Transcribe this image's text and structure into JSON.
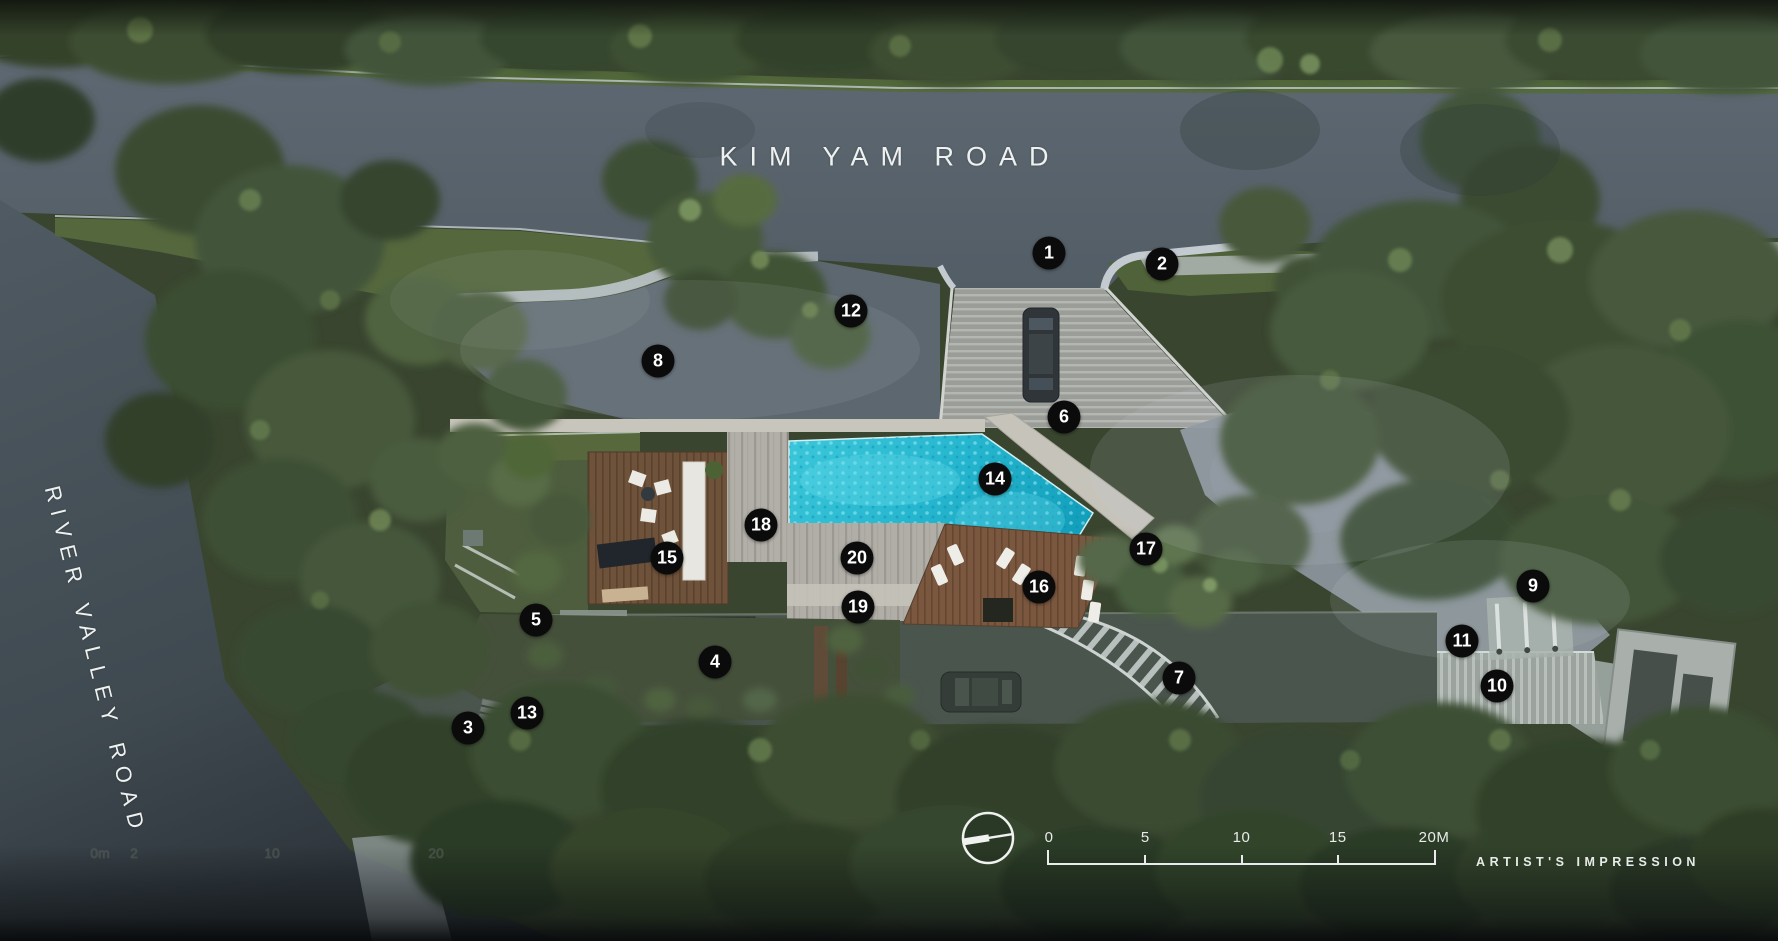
{
  "roads": {
    "top": "KIM YAM ROAD",
    "left": "RIVER VALLEY ROAD"
  },
  "credit": "ARTIST'S IMPRESSION",
  "scale_bar": {
    "labels": [
      "0",
      "5",
      "10",
      "15",
      "20M"
    ]
  },
  "ghost_scale": {
    "labels": [
      "0m",
      "2",
      "10",
      "20"
    ]
  },
  "markers": [
    {
      "n": "1",
      "x": 1049,
      "y": 253
    },
    {
      "n": "2",
      "x": 1162,
      "y": 264
    },
    {
      "n": "3",
      "x": 468,
      "y": 728
    },
    {
      "n": "4",
      "x": 715,
      "y": 662
    },
    {
      "n": "5",
      "x": 536,
      "y": 620
    },
    {
      "n": "6",
      "x": 1064,
      "y": 417
    },
    {
      "n": "7",
      "x": 1179,
      "y": 678
    },
    {
      "n": "8",
      "x": 658,
      "y": 361
    },
    {
      "n": "9",
      "x": 1533,
      "y": 586
    },
    {
      "n": "10",
      "x": 1497,
      "y": 686
    },
    {
      "n": "11",
      "x": 1462,
      "y": 641
    },
    {
      "n": "12",
      "x": 851,
      "y": 311
    },
    {
      "n": "13",
      "x": 527,
      "y": 713
    },
    {
      "n": "14",
      "x": 995,
      "y": 479
    },
    {
      "n": "15",
      "x": 667,
      "y": 558
    },
    {
      "n": "16",
      "x": 1039,
      "y": 587
    },
    {
      "n": "17",
      "x": 1146,
      "y": 549
    },
    {
      "n": "18",
      "x": 761,
      "y": 525
    },
    {
      "n": "19",
      "x": 858,
      "y": 607
    },
    {
      "n": "20",
      "x": 857,
      "y": 558
    }
  ],
  "colors": {
    "marker_bg": "#0b0b0c",
    "text": "#edf1ef",
    "road": "#57616b",
    "pool": "#2ec5db",
    "trees_dark": "#34432c",
    "wood_deck": "#6f523a"
  }
}
